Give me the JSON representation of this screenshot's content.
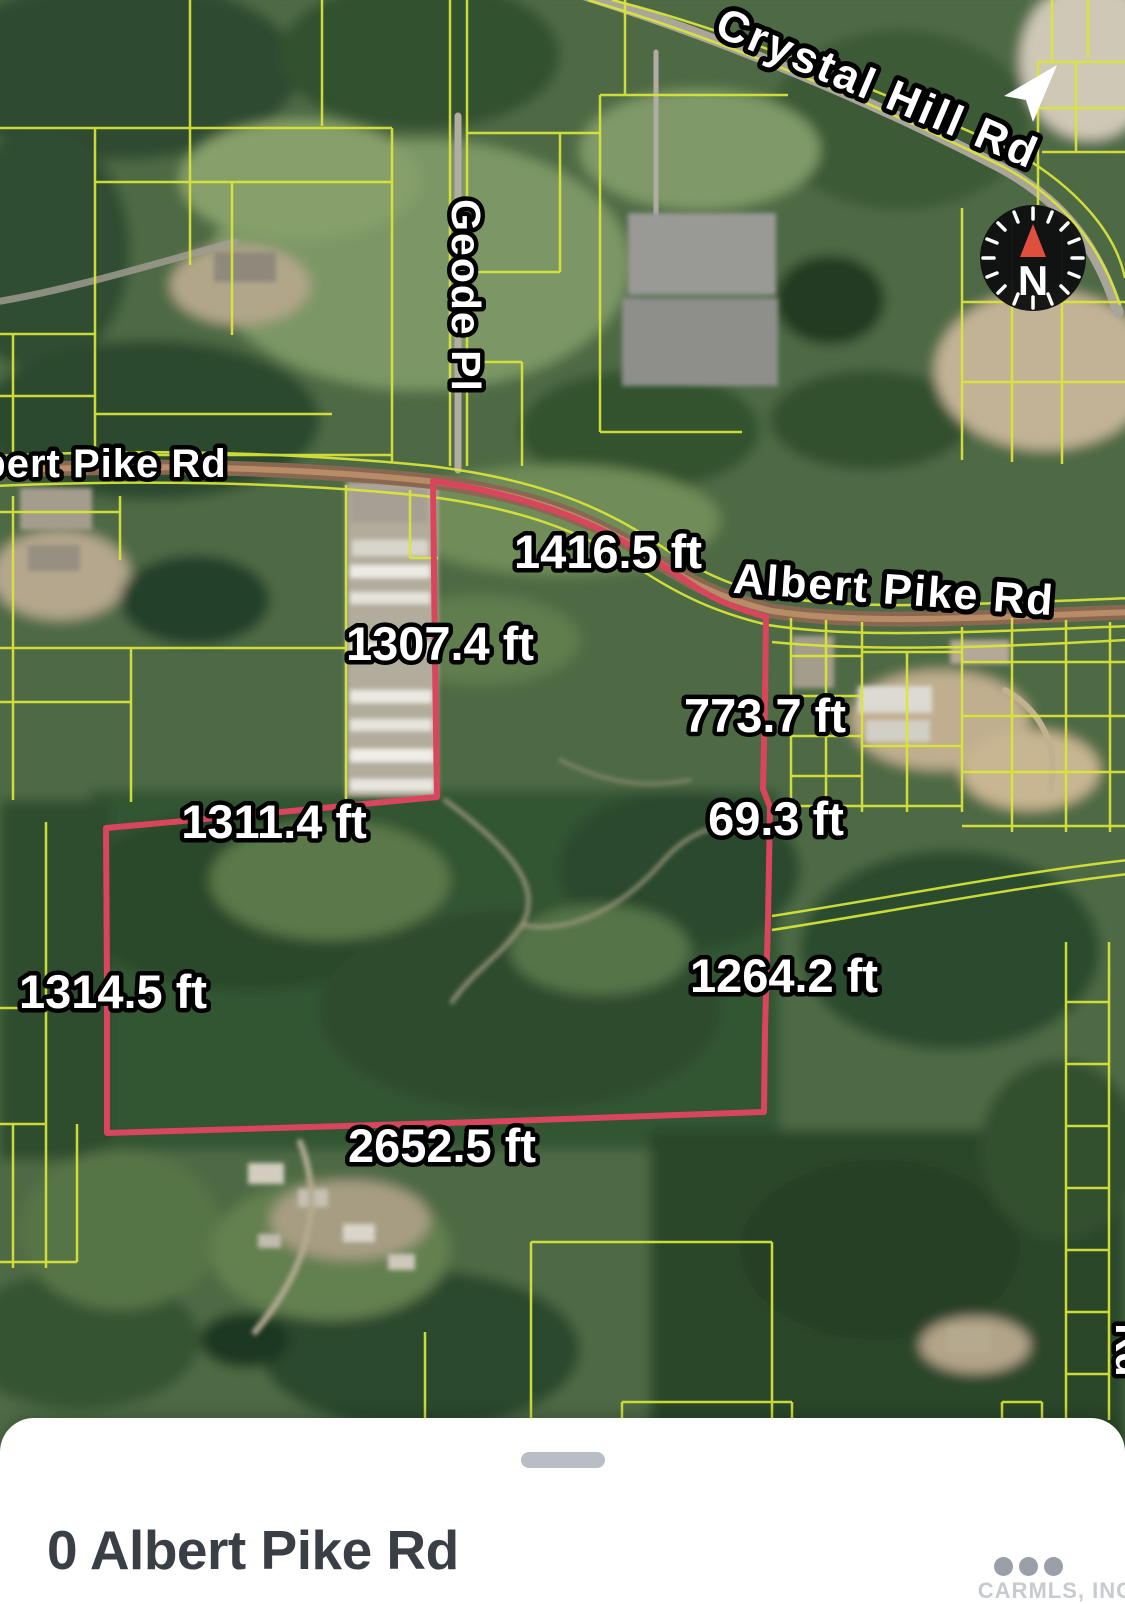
{
  "map": {
    "road_labels": {
      "crystal_hill": "Crystal Hill Rd",
      "geode_pl": "Geode Pl",
      "albert_pike_left": "bert Pike Rd",
      "albert_pike_right": "Albert Pike Rd",
      "partial_right": "Rd"
    },
    "measurements": {
      "north": "1416.5 ft",
      "inner_west": "1307.4 ft",
      "east_upper": "773.7 ft",
      "east_jog": "69.3 ft",
      "mid": "1311.4 ft",
      "west": "1314.5 ft",
      "east_lower": "1264.2 ft",
      "south": "2652.5 ft"
    },
    "compass_label": "N",
    "icons": {
      "compass": "compass-icon",
      "location": "navigation-arrow-icon"
    },
    "colors": {
      "parcel_boundary": "#d8455c",
      "parcel_lines": "#dbe739",
      "compass_needle": "#de4f3d",
      "road_label_fill": "#ffffff"
    }
  },
  "bottom_sheet": {
    "title": "0 Albert Pike Rd",
    "watermark": "CARMLS, INC",
    "icons": {
      "more": "ellipsis-icon"
    },
    "colors": {
      "title": "#3a3f46",
      "handle": "#b9bdc4"
    }
  }
}
